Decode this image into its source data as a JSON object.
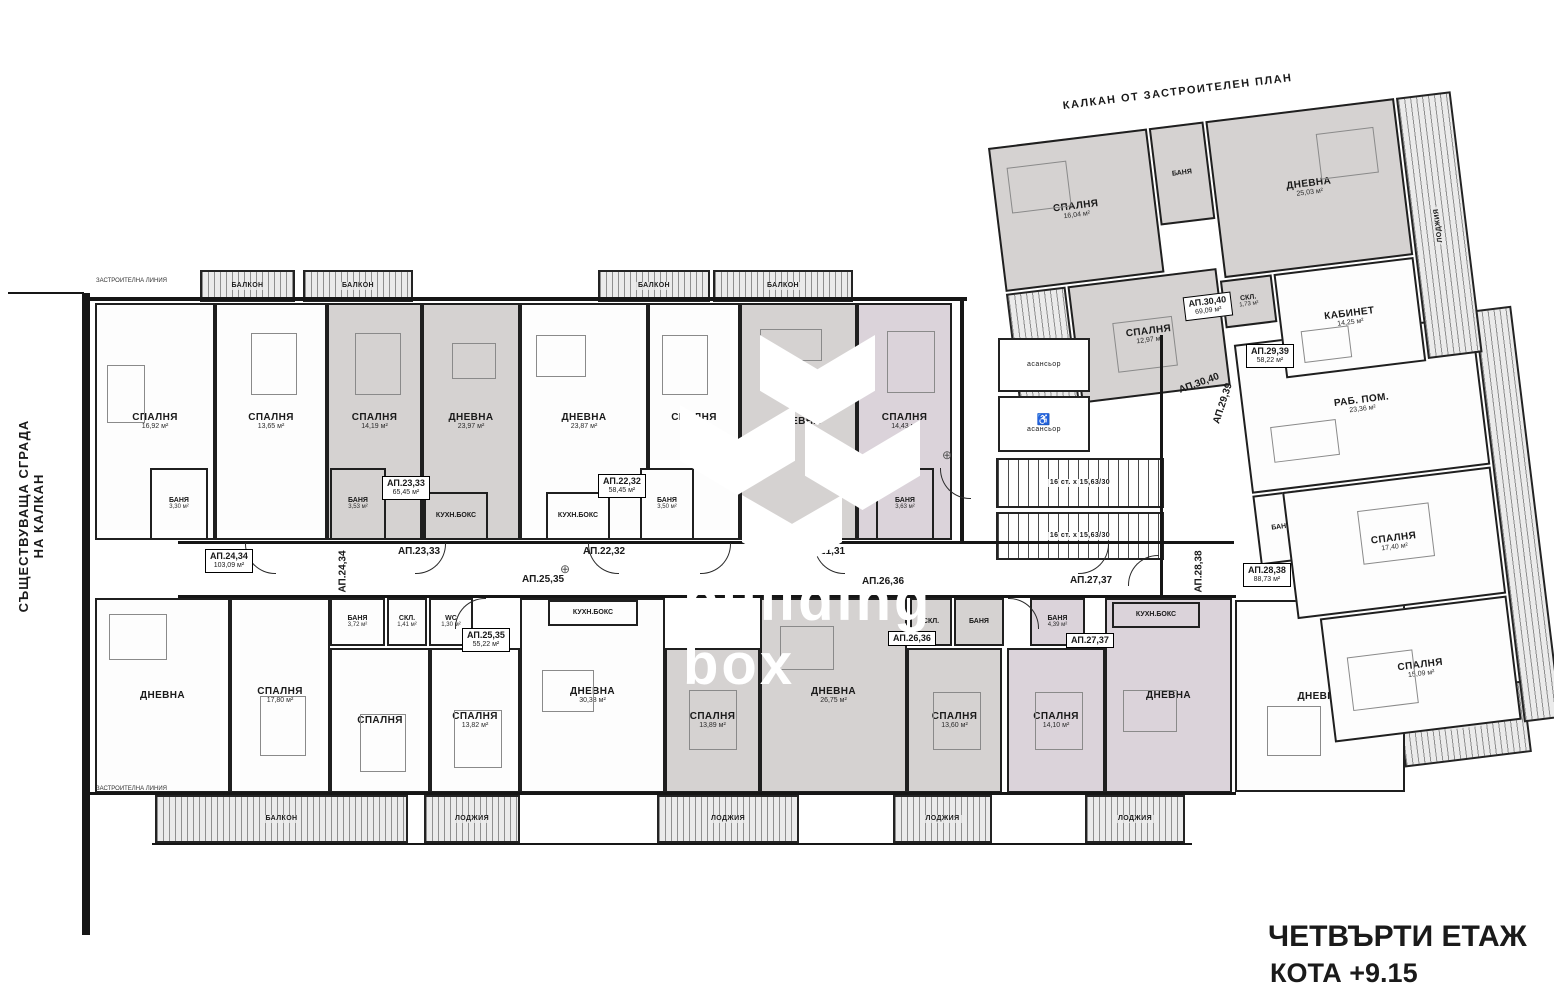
{
  "title": {
    "line1": "ЧЕТВЪРТИ ЕТАЖ",
    "line2": "КОТА +9.15"
  },
  "annotations": {
    "top_boundary": "КАЛКАН ОТ ЗАСТРОИТЕЛЕН ПЛАН",
    "existing_building_line1": "СЪЩЕСТВУВАЩА СГРАДА",
    "existing_building_line2": "НА КАЛКАН",
    "building_line": "ЗАСТРОИТЕЛНА ЛИНИЯ",
    "watermark_line1": "building",
    "watermark_line2": "box"
  },
  "colors": {
    "wall": "#161616",
    "gray_apartment": "#d5d2d1",
    "lavender_apartment": "#dbd3da",
    "white_apartment": "#fdfdfd"
  },
  "core": {
    "elevator": "асансьор",
    "stairs": "16 ст. х 15,63/30",
    "wheelchair": "♿"
  },
  "apartments": [
    {
      "tag": "АП.21,31"
    },
    {
      "tag": "АП.22,32",
      "area": "58,45 м²"
    },
    {
      "tag": "АП.23,33",
      "area": "65,45 м²"
    },
    {
      "tag": "АП.24,34",
      "area": "103,09 м²"
    },
    {
      "tag": "АП.25,35",
      "area": "55,22 м²"
    },
    {
      "tag": "АП.26,36"
    },
    {
      "tag": "АП.27,37"
    },
    {
      "tag": "АП.28,38",
      "area": "88,73 м²"
    },
    {
      "tag": "АП.29,39",
      "area": "58,22 м²"
    },
    {
      "tag": "АП.30,40",
      "area": "69,09 м²"
    }
  ],
  "rooms": [
    {
      "label": "СПАЛНЯ",
      "area": "16,92 м²"
    },
    {
      "label": "СПАЛНЯ",
      "area": "13,65 м²"
    },
    {
      "label": "СПАЛНЯ",
      "area": "14,19 м²"
    },
    {
      "label": "ДНЕВНА",
      "area": "23,97 м²"
    },
    {
      "label": "ДНЕВНА",
      "area": "23,87 м²"
    },
    {
      "label": "СПАЛНЯ",
      "area": "14,19 м²"
    },
    {
      "label": "ДНЕВНА"
    },
    {
      "label": "СПАЛНЯ",
      "area": "14,43 м²"
    },
    {
      "label": "БАНЯ",
      "area": "3,30 м²"
    },
    {
      "label": "БАНЯ",
      "area": "3,53 м²"
    },
    {
      "label": "КУХН.БОКС"
    },
    {
      "label": "КУХН.БОКС"
    },
    {
      "label": "БАНЯ",
      "area": "3,50 м²"
    },
    {
      "label": "БАНЯ",
      "area": "3,63 м²"
    },
    {
      "label": "ДНЕВНА"
    },
    {
      "label": "СПАЛНЯ",
      "area": "17,80 м²"
    },
    {
      "label": "СПАЛНЯ"
    },
    {
      "label": "СПАЛНЯ",
      "area": "13,82 м²"
    },
    {
      "label": "ДНЕВНА",
      "area": "30,38 м²"
    },
    {
      "label": "СПАЛНЯ",
      "area": "13,89 м²"
    },
    {
      "label": "ДНЕВНА",
      "area": "26,75 м²"
    },
    {
      "label": "СПАЛНЯ",
      "area": "13,60 м²"
    },
    {
      "label": "СПАЛНЯ",
      "area": "14,10 м²"
    },
    {
      "label": "ДНЕВНА"
    },
    {
      "label": "ДНЕВНА"
    },
    {
      "label": "БАНЯ",
      "area": "3,72 м²"
    },
    {
      "label": "СКЛ.",
      "area": "1,41 м²"
    },
    {
      "label": "WC",
      "area": "1,30 м²"
    },
    {
      "label": "КУХН.БОКС"
    },
    {
      "label": "СКЛ."
    },
    {
      "label": "БАНЯ"
    },
    {
      "label": "БАНЯ",
      "area": "4,39 м²"
    },
    {
      "label": "КУХН.БОКС"
    },
    {
      "label": "РАБ. ПОМ.",
      "area": "23,36 м²"
    },
    {
      "label": "СПАЛНЯ",
      "area": "17,40 м²"
    },
    {
      "label": "СПАЛНЯ",
      "area": "15,09 м²"
    },
    {
      "label": "БАНЯ"
    },
    {
      "label": "СПАЛНЯ",
      "area": "16,04 м²"
    },
    {
      "label": "БАНЯ"
    },
    {
      "label": "ДНЕВНА",
      "area": "25,03 м²"
    },
    {
      "label": "СПАЛНЯ",
      "area": "12,97 м²"
    },
    {
      "label": "СКЛ.",
      "area": "1,73 м²"
    },
    {
      "label": "КАБИНЕТ",
      "area": "14,25 м²"
    }
  ],
  "balconies": [
    {
      "label": "БАЛКОН"
    },
    {
      "label": "БАЛКОН"
    },
    {
      "label": "БАЛКОН"
    },
    {
      "label": "БАЛКОН"
    },
    {
      "label": "БАЛКОН"
    },
    {
      "label": "ЛОДЖИЯ"
    },
    {
      "label": "ЛОДЖИЯ"
    },
    {
      "label": "ЛОДЖИЯ"
    },
    {
      "label": "ЛОДЖИЯ"
    },
    {
      "label": "БАЛКОН"
    },
    {
      "label": "ЛОДЖИЯ"
    },
    {
      "label": "ЛОДЖИЯ"
    }
  ]
}
